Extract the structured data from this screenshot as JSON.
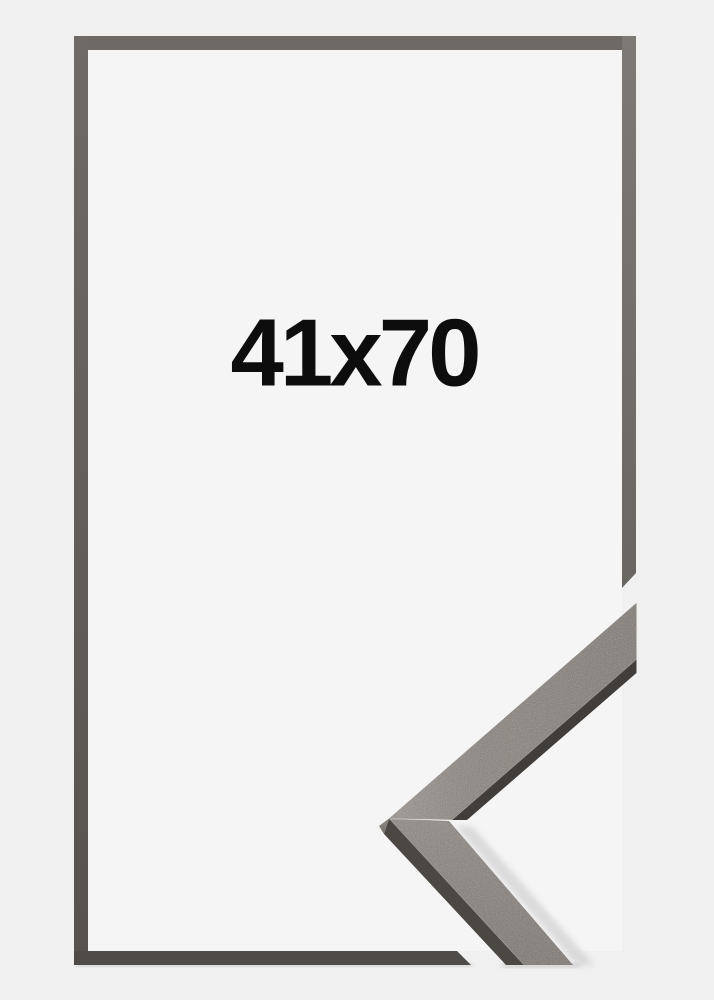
{
  "product": {
    "size_label": "41x70"
  },
  "colors": {
    "background": "#f0f0f1",
    "inner_background": "#f5f5f6",
    "frame_top": "#6e6965",
    "frame_left_start": "#6f6a66",
    "frame_left_end": "#56524e",
    "frame_right_start": "#7d7975",
    "frame_right_end": "#696561",
    "frame_bottom": "#4f4b48",
    "sample_face": "#827c76",
    "sample_face_light": "#8b857e",
    "sample_edge_dark": "#403d3a",
    "sample_edge_left": "#4b4743",
    "sample_end_face_light": "#948e87",
    "sample_end_face_dark": "#6e6963",
    "shadow": "#c6c6c8",
    "text": "#0d0d0d"
  }
}
